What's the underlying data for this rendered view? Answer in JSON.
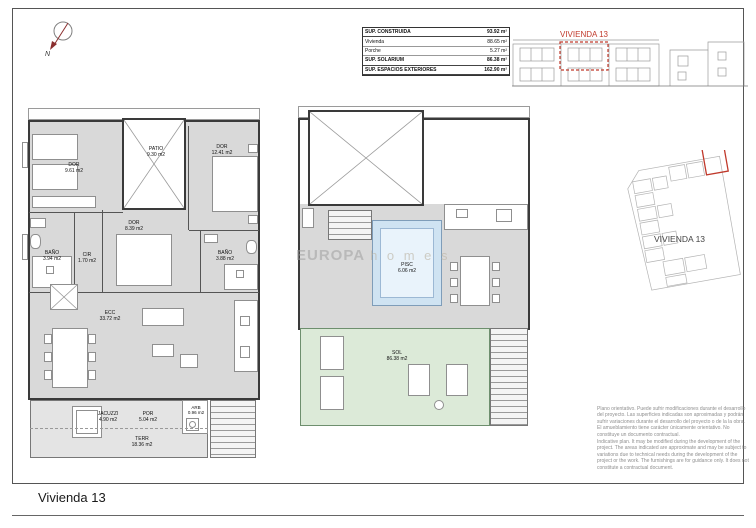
{
  "page": {
    "title": "Vivienda 13"
  },
  "north_arrow": {
    "label": "N"
  },
  "area_table": {
    "rows": [
      {
        "label": "SUP. CONSTRUIDA",
        "value": "93.92 m²"
      },
      {
        "label": "Vivienda",
        "value": "88.65 m²"
      },
      {
        "label": "Porche",
        "value": "5.27 m²"
      },
      {
        "label": "SUP. SOLARIUM",
        "value": "86.38 m²"
      },
      {
        "label": "SUP. ESPACIOS EXTERIORES",
        "value": "162.90 m²"
      }
    ]
  },
  "elevation": {
    "unit_label": "VIVIENDA 13"
  },
  "site_plan": {
    "unit_label": "VIVIENDA 13"
  },
  "floor_plan": {
    "rooms": {
      "dor1": {
        "name": "DOR",
        "area": "9.61 m2"
      },
      "patio": {
        "name": "PATIO",
        "area": "9.30 m2"
      },
      "dor2": {
        "name": "DOR",
        "area": "12.41 m2"
      },
      "dor3": {
        "name": "DOR",
        "area": "8.39 m2"
      },
      "bano1": {
        "name": "BAÑO",
        "area": "3.94 m2"
      },
      "cir": {
        "name": "CIR",
        "area": "1.70 m2"
      },
      "bano2": {
        "name": "BAÑO",
        "area": "3.88 m2"
      },
      "ecc": {
        "name": "ECC",
        "area": "33.72 m2"
      },
      "jacuzzi": {
        "name": "JACUZZI",
        "area": "4.90 m2"
      },
      "por": {
        "name": "POR",
        "area": "5.04 m2"
      },
      "terr": {
        "name": "TERR",
        "area": "18.36 m2"
      },
      "arb": {
        "name": "ARB",
        "area": "0.96 m2"
      }
    }
  },
  "solarium_plan": {
    "rooms": {
      "pisc": {
        "name": "PISC",
        "area": "6.06 m2"
      },
      "sol": {
        "name": "SOL",
        "area": "86.38 m2"
      }
    }
  },
  "watermark": {
    "brand": "EUROPA",
    "suffix": "h o m e s"
  },
  "disclaimer": {
    "es": "Plano orientativo. Puede sufrir modificaciones durante el desarrollo del proyecto. Las superficies indicadas son aproximadas y podrán sufrir variaciones durante el desarrollo del proyecto o de la la obra. El amueblamiento tiene carácter únicamente orientativo. No constituye un documento contractual.",
    "en": "Indicative plan. It may be modified during the development of the project. The areas indicated are approximate and may be subject to variations due to technical needs during the development of the project or the work. The furnishings are for guidance only. It does not constitute a contractual document."
  },
  "colors": {
    "accent_red": "#c0392b",
    "floor_gray": "#d9d9d9",
    "solarium_green": "#dcead8",
    "pool_blue": "#cfe3f2"
  }
}
